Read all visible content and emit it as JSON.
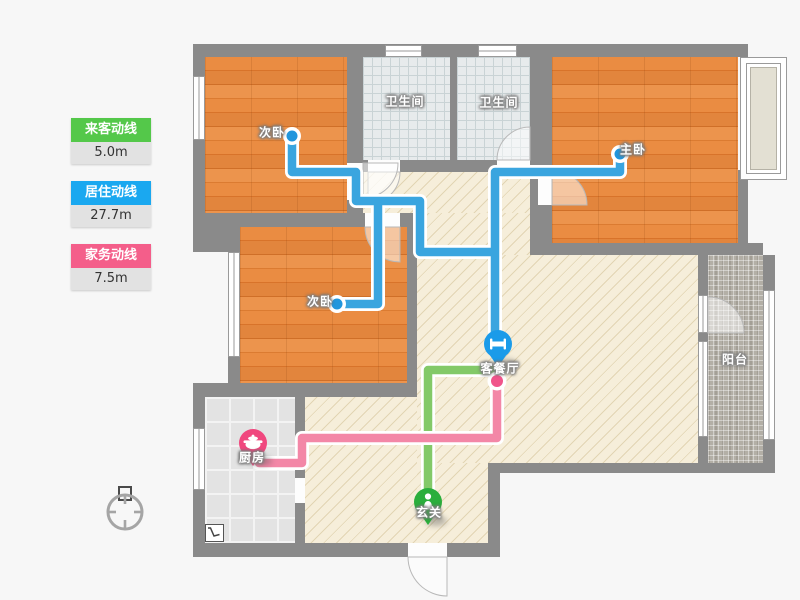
{
  "app": {
    "type": "floor-plan-route-viewer"
  },
  "legend": {
    "items": [
      {
        "id": "guest-route",
        "label": "来客动线",
        "value": "5.0m",
        "color": "#54c84a"
      },
      {
        "id": "resident-route",
        "label": "居住动线",
        "value": "27.7m",
        "color": "#1aa8f0"
      },
      {
        "id": "housework-route",
        "label": "家务动线",
        "value": "7.5m",
        "color": "#f45e8a"
      }
    ]
  },
  "rooms": [
    {
      "id": "bedroom-top-left",
      "label": "次卧"
    },
    {
      "id": "bathroom-1",
      "label": "卫生间"
    },
    {
      "id": "bathroom-2",
      "label": "卫生间"
    },
    {
      "id": "master-bedroom",
      "label": "主卧"
    },
    {
      "id": "bedroom-mid-left",
      "label": "次卧"
    },
    {
      "id": "living-dining",
      "label": "客餐厅"
    },
    {
      "id": "kitchen",
      "label": "厨房"
    },
    {
      "id": "entry",
      "label": "玄关"
    },
    {
      "id": "balcony",
      "label": "阳台"
    }
  ],
  "lines": {
    "resident": {
      "color": "#3aa5df",
      "casing": "#ffffff"
    },
    "guest": {
      "color": "#83c968",
      "casing": "#ffffff"
    },
    "housework": {
      "color": "#f387a7",
      "casing": "#ffffff"
    }
  },
  "markers": {
    "living": {
      "icon": "bed-icon",
      "color": "#1b9be9"
    },
    "entry": {
      "icon": "person-icon",
      "color": "#2bae3c"
    },
    "kitchen": {
      "icon": "cooking-pot-icon",
      "color": "#f0477e"
    }
  },
  "endpoints": {
    "resident_cap": "#2196dd",
    "housework_cap": "#f0548a"
  }
}
